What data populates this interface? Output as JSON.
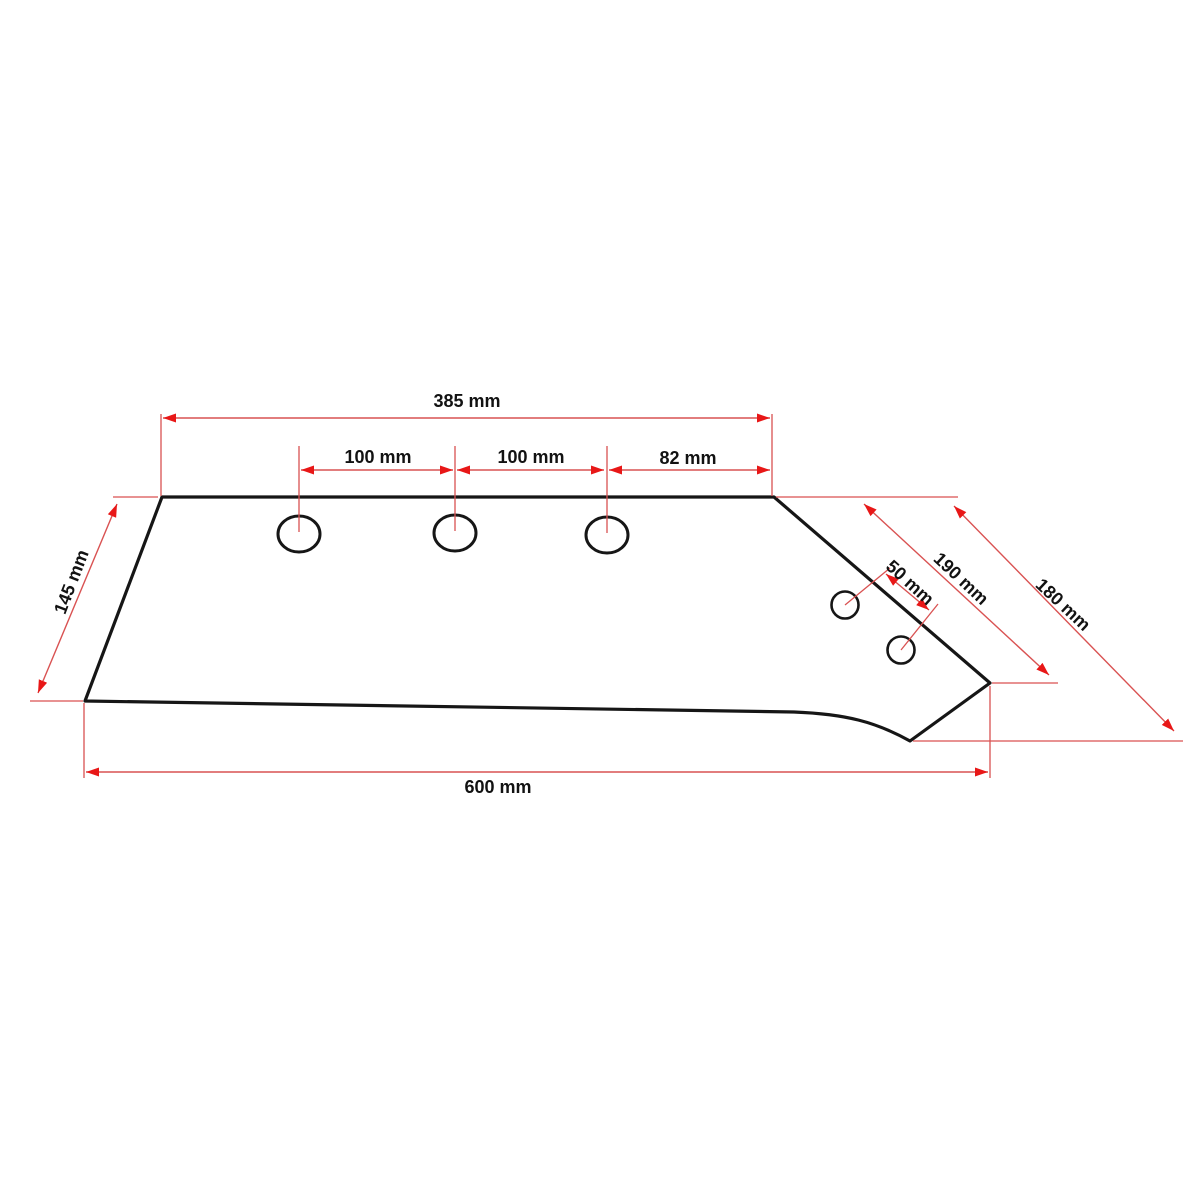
{
  "colors": {
    "background": "#ffffff",
    "outline": "#161616",
    "dimension_line": "#d95252",
    "arrow": "#e81717",
    "label": "#121212"
  },
  "labels": {
    "top_width": "385 mm",
    "hole_pitch_1": "100 mm",
    "hole_pitch_2": "100 mm",
    "hole_pitch_3": "82 mm",
    "left_edge_height": "145 mm",
    "right_edge_length": "190 mm",
    "right_diagonal_length": "180 mm",
    "small_hole_pitch": "50 mm",
    "bottom_width": "600 mm"
  }
}
